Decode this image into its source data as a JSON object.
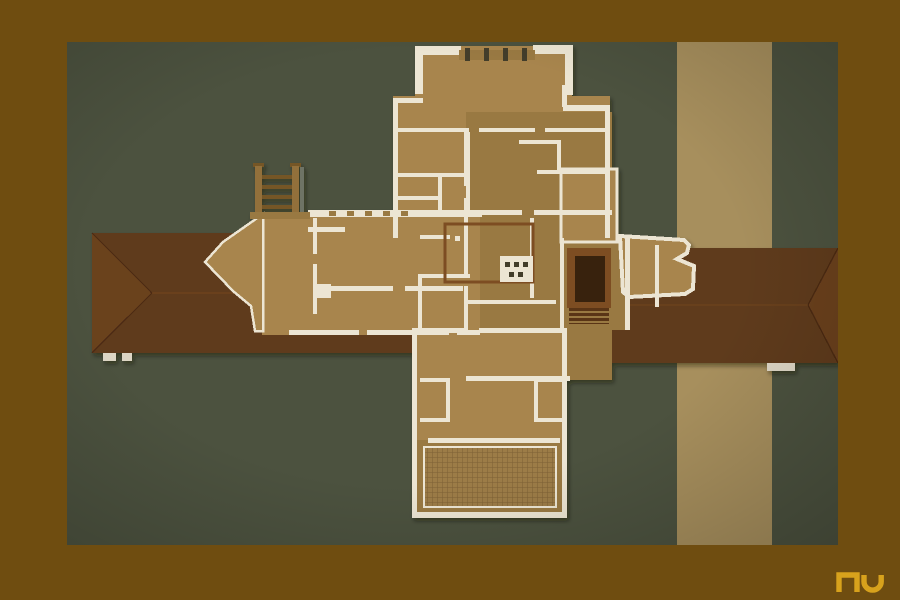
{
  "scene": {
    "description": "Overhead photograph of a cruciform prairie-style architectural model with tan chipboard floors, cream walls and dark hipped roof planes, pinned to an olive-green mat crossed by a vertical tan stripe, surrounded by a brown frame",
    "aria_label": "Overhead photograph of a cruciform architectural house model on a green mat",
    "watermark_label": "nu",
    "watermark_aria": "Gold nu monogram watermark"
  },
  "colors": {
    "frame": "#6f4d10",
    "mat": "#4c523f",
    "stripe": "#a78f5d",
    "roof": "#5f3a1d",
    "roof-light": "#7b4d22",
    "roof-dark": "#46270f",
    "floor": "#a8854d",
    "floor2": "#997943",
    "wall": "#ece5d3",
    "notch": "#433d2a",
    "stair": "#5a3517",
    "stair-dark": "#38200b",
    "mason": "#7d4d21",
    "perg": "#926f3a",
    "perg-dark": "#755627",
    "perg-shadow": "#6e7365",
    "pier": "#ddd6c5",
    "grid-base": "#9c7c46",
    "grid-line": "#7d6134",
    "logo": "#d8a21c"
  }
}
